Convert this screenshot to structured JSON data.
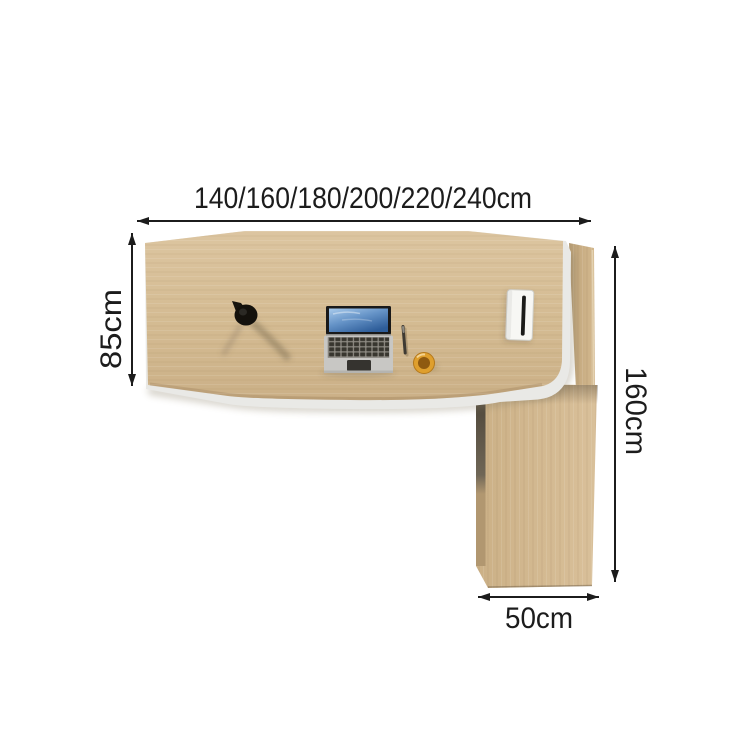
{
  "title": "L-shaped office desk top-view dimension diagram",
  "dimensions": {
    "width_options": "140/160/180/200/220/240cm",
    "depth": "85cm",
    "side_length": "160cm",
    "return_width": "50cm"
  },
  "objects": {
    "lamp": "desk-lamp",
    "laptop": "laptop",
    "pen": "pen",
    "cup": "coffee-cup",
    "grommet": "cable-grommet"
  },
  "colors": {
    "background": "#ffffff",
    "desk_wood": "#d6bd96",
    "side_wood": "#c4a97f",
    "edge_band": "#e9e9e6",
    "annotation": "#1c1c1c",
    "laptop_screen_blue": "#41699f",
    "cup_orange": "#df9f2d"
  }
}
